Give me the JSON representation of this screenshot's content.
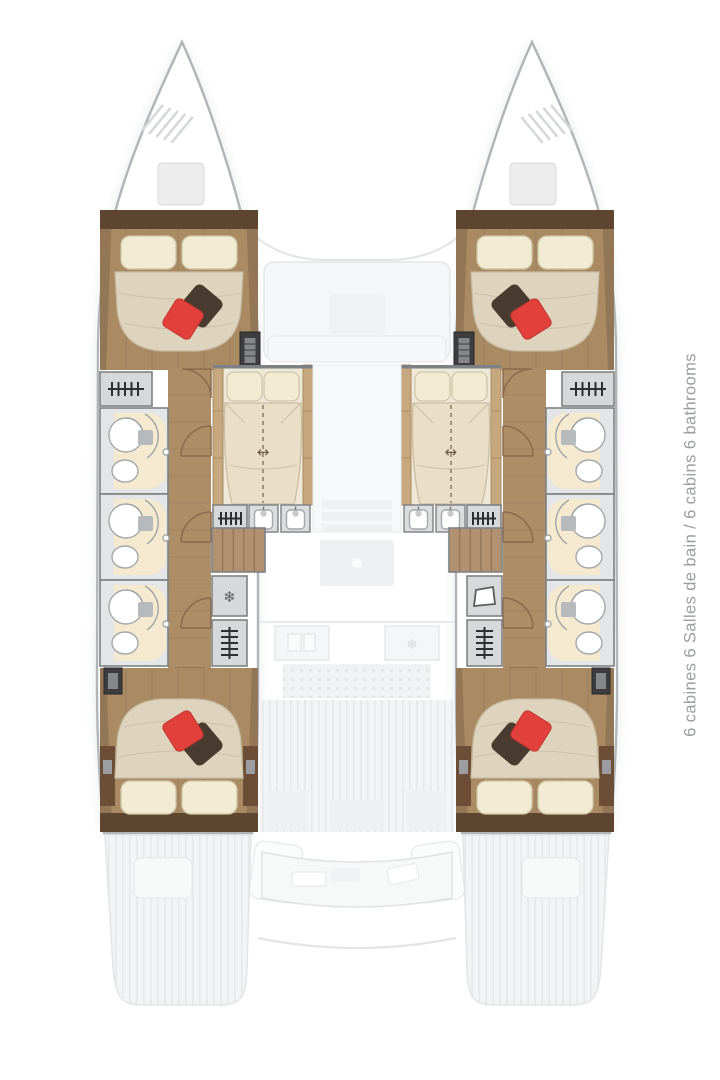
{
  "window": {
    "width": 720,
    "height": 1080,
    "background": "#ffffff"
  },
  "caption": {
    "text": "6 cabines 6 Salles de bain / 6 cabins 6 bathrooms",
    "color": "#9b9da0"
  },
  "plan": {
    "type": "catamaran-interior-deck-plan",
    "view": "top-down",
    "cabins": 6,
    "bathrooms": 6,
    "icons": {
      "convertible-bed-arrow": "↔",
      "fridge-snowflake": "❄"
    },
    "colors": {
      "hull-outline": "#b2b5b8",
      "wood-floor": "#a98a63",
      "wood-dark": "#5e4530",
      "wood-trim": "#c7a87e",
      "corridor-wood": "#ac8d66",
      "step-wood": "#b29171",
      "mattress": "#ded3bd",
      "mattress-light": "#eadfc6",
      "pillow": "#f1ebd2",
      "pillow-red": "#e2413b",
      "pillow-brown": "#4a3b30",
      "bath-floor": "#f5ead0",
      "bath-room": "#e4e5e6",
      "wall": "#7e8183",
      "door": "#8a6a4c",
      "ghost-fill": "#f5f6f7",
      "ghost-line": "#e3e5e7",
      "caption": "#9b9da0"
    }
  }
}
